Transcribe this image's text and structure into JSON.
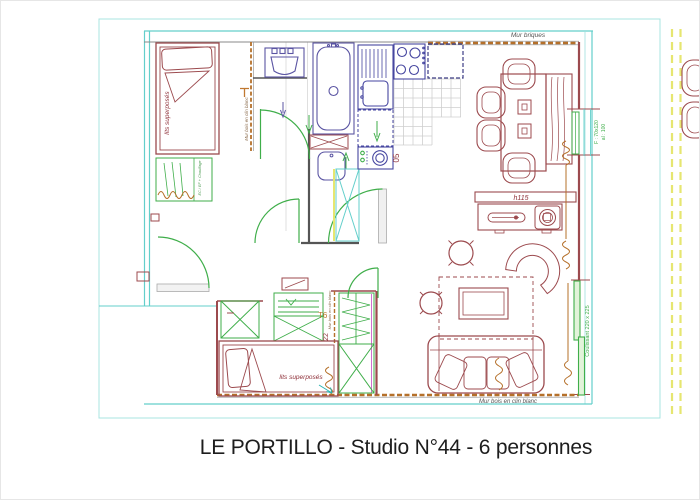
{
  "caption": "LE PORTILLO - Studio N°44 - 6 personnes",
  "plan": {
    "walls": {
      "top_label": "Mur briques",
      "bottom_label": "Mur bois en clin blanc",
      "partition_top_label": "Mur bois en clin blanc",
      "partition_bottom_label": "Mur bois en clin blanc"
    },
    "bedroom_top": {
      "bed_label": "lits superposés",
      "shelf_note": "EC / EF + Chauffage"
    },
    "bedroom_bottom": {
      "bed_label": "lits superposés",
      "type_marker": "T6",
      "dim_marker": "22"
    },
    "kitchen": {
      "dim_marker": "05"
    },
    "living": {
      "sideboard_height": "h115"
    },
    "openings": {
      "window_right_line1": "F : 70x120",
      "window_right_line2": "al : 100",
      "sliding_bay": "Coulissant 220 x 225"
    },
    "colors": {
      "construction_cyan": "#63cfcb",
      "frame_cyan": "#a8e4e1",
      "masonry_red": "#9c4a4e",
      "wood_wall_brown": "#b5702a",
      "fixtures_purple": "#5b55a3",
      "kitchen_navy": "#4646a0",
      "joinery_green": "#3fae4a",
      "magenta_trim": "#cf6fcf",
      "boundary_yellow": "#e6e670",
      "label_red": "#8e2f38",
      "tile_gray": "#cfcfcf"
    }
  }
}
